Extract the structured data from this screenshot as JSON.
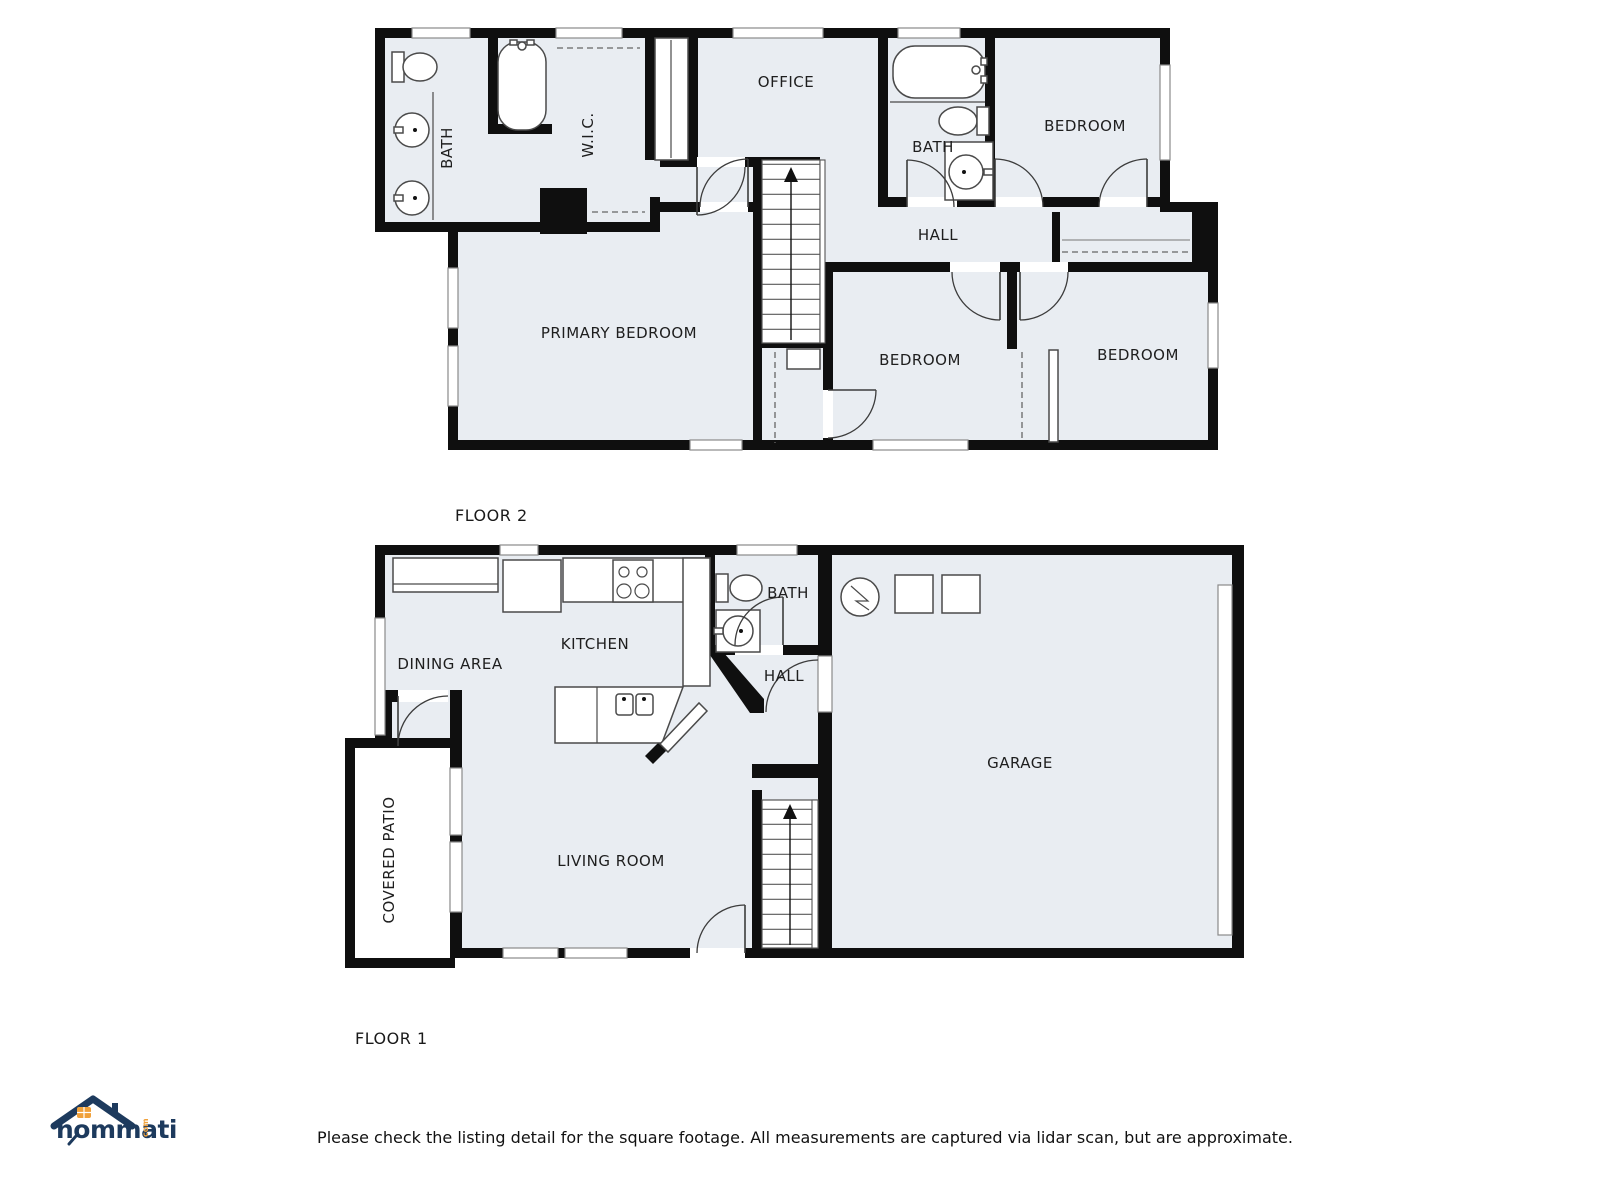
{
  "colors": {
    "wall": "#0f0f0f",
    "room_fill": "#e9edf2",
    "fixture_stroke": "#4a4a4a",
    "logo_navy": "#1d3a5d",
    "logo_orange": "#f0a13a"
  },
  "floor2": {
    "floor_label": "FLOOR 2",
    "rooms": {
      "bath_left": "BATH",
      "wic": "W.I.C.",
      "office": "OFFICE",
      "bath_center": "BATH",
      "bedroom_top_right": "BEDROOM",
      "hall": "HALL",
      "primary_bedroom": "PRIMARY BEDROOM",
      "bedroom_bottom_center": "BEDROOM",
      "bedroom_bottom_right": "BEDROOM"
    }
  },
  "floor1": {
    "floor_label": "FLOOR 1",
    "rooms": {
      "dining_area": "DINING AREA",
      "kitchen": "KITCHEN",
      "bath": "BATH",
      "hall": "HALL",
      "garage": "GARAGE",
      "covered_patio": "COVERED PATIO",
      "living_room": "LIVING ROOM"
    }
  },
  "footer": {
    "brand": "hommati",
    "brand_suffix": "com",
    "disclaimer": "Please check the listing detail for the square footage. All measurements are captured via lidar scan, but are approximate."
  }
}
